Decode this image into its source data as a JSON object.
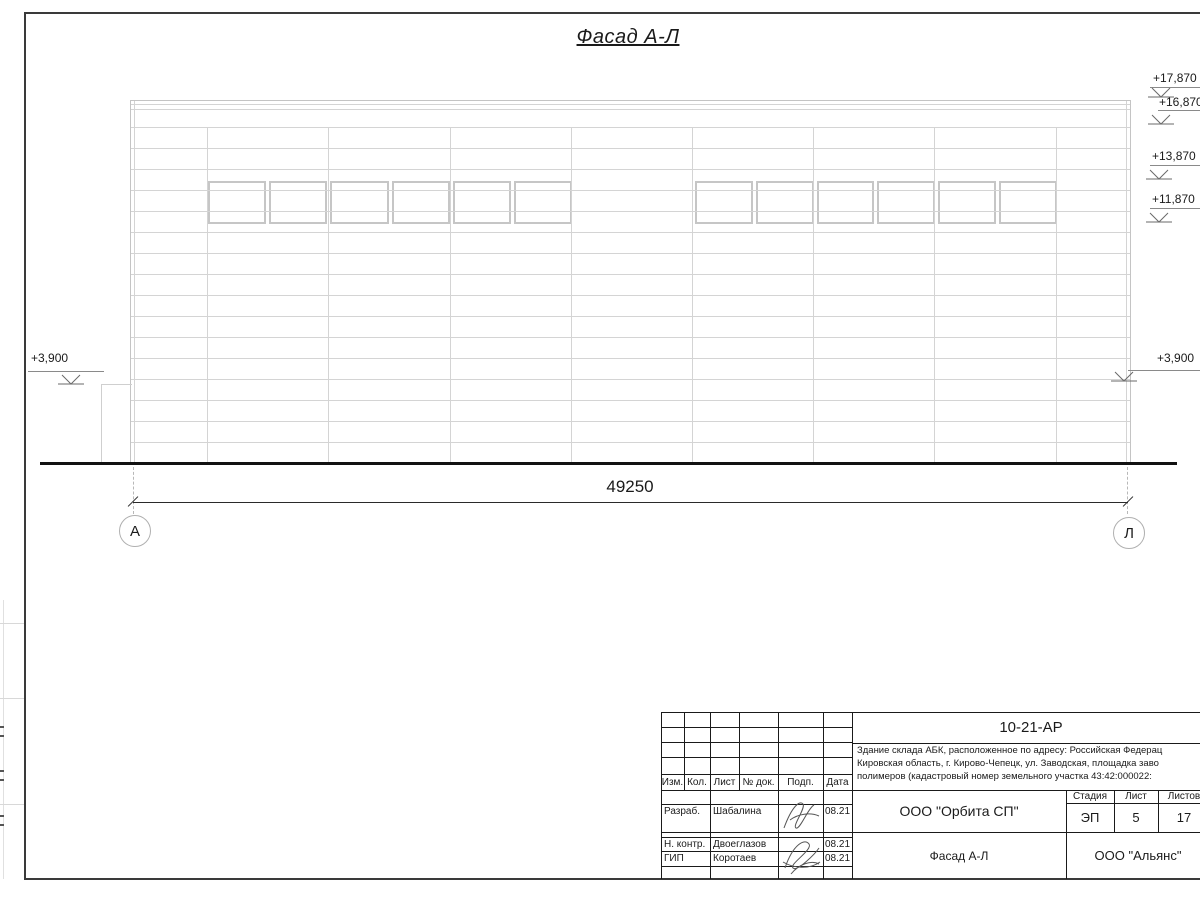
{
  "drawing": {
    "title": "Фасад А-Л",
    "dimension": "49250",
    "axis_left": "А",
    "axis_right": "Л",
    "elevations": {
      "right_1": "+17,870",
      "right_2": "+16,870",
      "right_3": "+13,870",
      "right_4": "+11,870",
      "right_5": "+3,900",
      "left_1": "+3,900"
    }
  },
  "title_block": {
    "doc_number": "10-21-АР",
    "description_line1": "Здание склада АБК, расположенное по адресу: Российская Федерац",
    "description_line2": "Кировская область, г. Кирово-Чепецк, ул. Заводская, площадка заво",
    "description_line3": "полимеров (кадастровый номер земельного участка 43:42:000022:",
    "revision_header": {
      "izm": "Изм.",
      "kol": "Кол.",
      "list": "Лист",
      "doc": "№ док.",
      "podp": "Подп.",
      "data": "Дата"
    },
    "signoff": [
      {
        "role": "Разраб.",
        "name": "Шабалина",
        "date": "08.21"
      },
      {
        "role": "Н. контр.",
        "name": "Двоеглазов",
        "date": "08.21"
      },
      {
        "role": "ГИП",
        "name": "Коротаев",
        "date": "08.21"
      }
    ],
    "org": "ООО \"Орбита СП\"",
    "sheet_title": "Фасад А-Л",
    "contractor": "ООО \"Альянс\"",
    "stage_header": {
      "stage": "Стадия",
      "sheet": "Лист",
      "sheets": "Листов"
    },
    "stage": "ЭП",
    "sheet_number": "5",
    "sheets_total": "17"
  },
  "colors": {
    "drawing_line": "#d4d4d4",
    "frame_line": "#1a1a1a"
  }
}
